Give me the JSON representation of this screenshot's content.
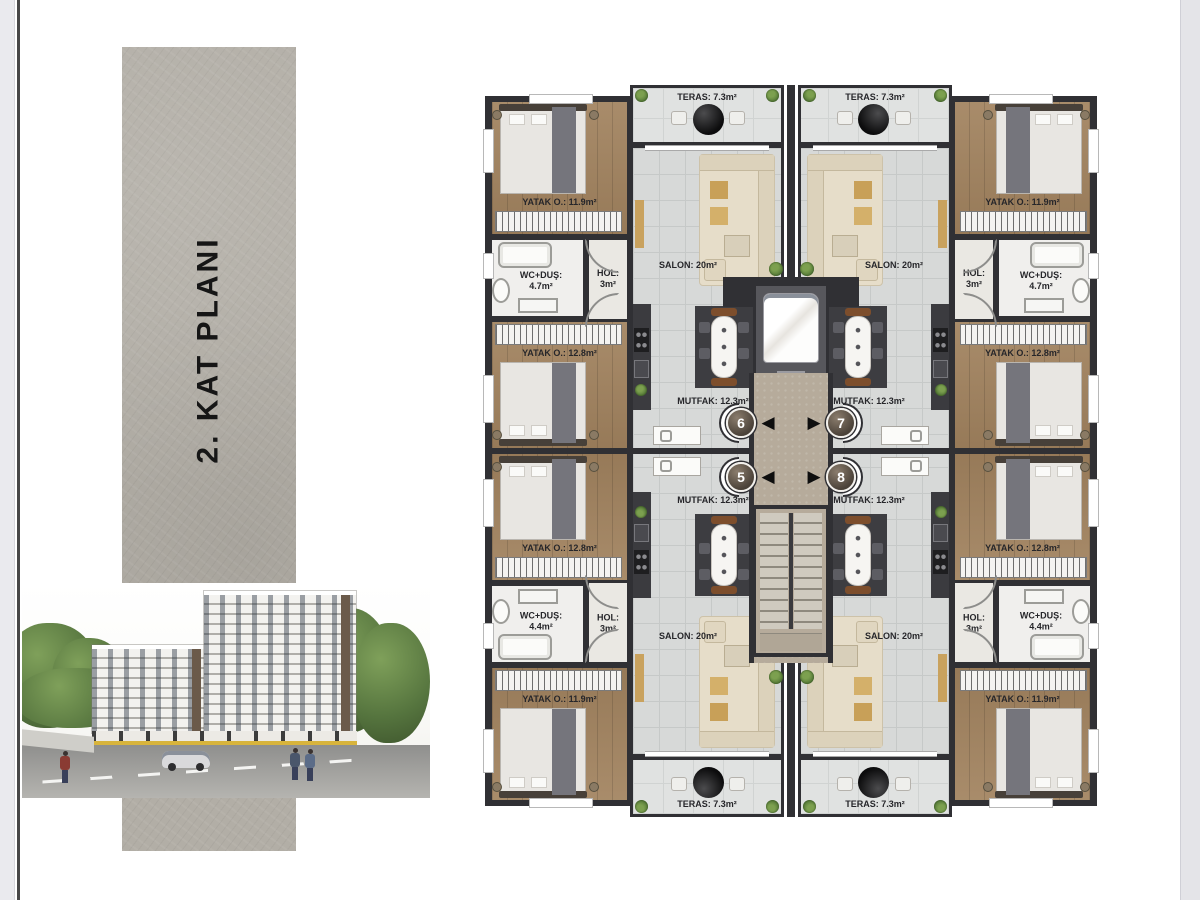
{
  "page": {
    "background": "#ffffff"
  },
  "left_panel": {
    "title": "2. KAT PLANI",
    "strip_color": "#b2aea6",
    "edge_bar_color": "#eaeaee",
    "edge_line_color": "#474747",
    "right_bar_color": "#e4e4e8",
    "render_colors": {
      "building": "#f3f2ef",
      "trees": "#5d7a44",
      "road": "#9c9b98",
      "accent_yellow": "#d8b43c"
    }
  },
  "plan": {
    "colors": {
      "wall": "#303034",
      "wood_floor": "#a2835f",
      "tile_floor": "#d7d9d8",
      "teras_floor": "#e0e2e1",
      "corridor": "#b6ab9b",
      "label": "#26262a"
    },
    "units": [
      {
        "number": "6",
        "position": "top-left",
        "arrow": "◀",
        "rooms": {
          "teras": "TERAS: 7.3m²",
          "salon": "SALON: 20m²",
          "mutfak": "MUTFAK: 12.3m²",
          "bedroom1": "YATAK O.: 11.9m²",
          "bedroom2": "YATAK O.: 12.8m²",
          "wc_name": "WC+DUŞ:",
          "wc_area": "4.7m²",
          "hol_name": "HOL:",
          "hol_area": "3m²"
        }
      },
      {
        "number": "7",
        "position": "top-right",
        "arrow": "▶",
        "rooms": {
          "teras": "TERAS: 7.3m²",
          "salon": "SALON: 20m²",
          "mutfak": "MUTFAK: 12.3m²",
          "bedroom1": "YATAK O.: 11.9m²",
          "bedroom2": "YATAK O.: 12.8m²",
          "wc_name": "WC+DUŞ:",
          "wc_area": "4.7m²",
          "hol_name": "HOL:",
          "hol_area": "3m²"
        }
      },
      {
        "number": "5",
        "position": "bottom-left",
        "arrow": "◀",
        "rooms": {
          "teras": "TERAS: 7.3m²",
          "salon": "SALON: 20m²",
          "mutfak": "MUTFAK: 12.3m²",
          "bedroom1": "YATAK O.: 11.9m²",
          "bedroom2": "YATAK O.: 12.8m²",
          "wc_name": "WC+DUŞ:",
          "wc_area": "4.4m²",
          "hol_name": "HOL:",
          "hol_area": "3m²"
        }
      },
      {
        "number": "8",
        "position": "bottom-right",
        "arrow": "▶",
        "rooms": {
          "teras": "TERAS: 7.3m²",
          "salon": "SALON: 20m²",
          "mutfak": "MUTFAK: 12.3m²",
          "bedroom1": "YATAK O.: 11.9m²",
          "bedroom2": "YATAK O.: 12.8m²",
          "wc_name": "WC+DUŞ:",
          "wc_area": "4.4m²",
          "hol_name": "HOL:",
          "hol_area": "3m²"
        }
      }
    ]
  }
}
